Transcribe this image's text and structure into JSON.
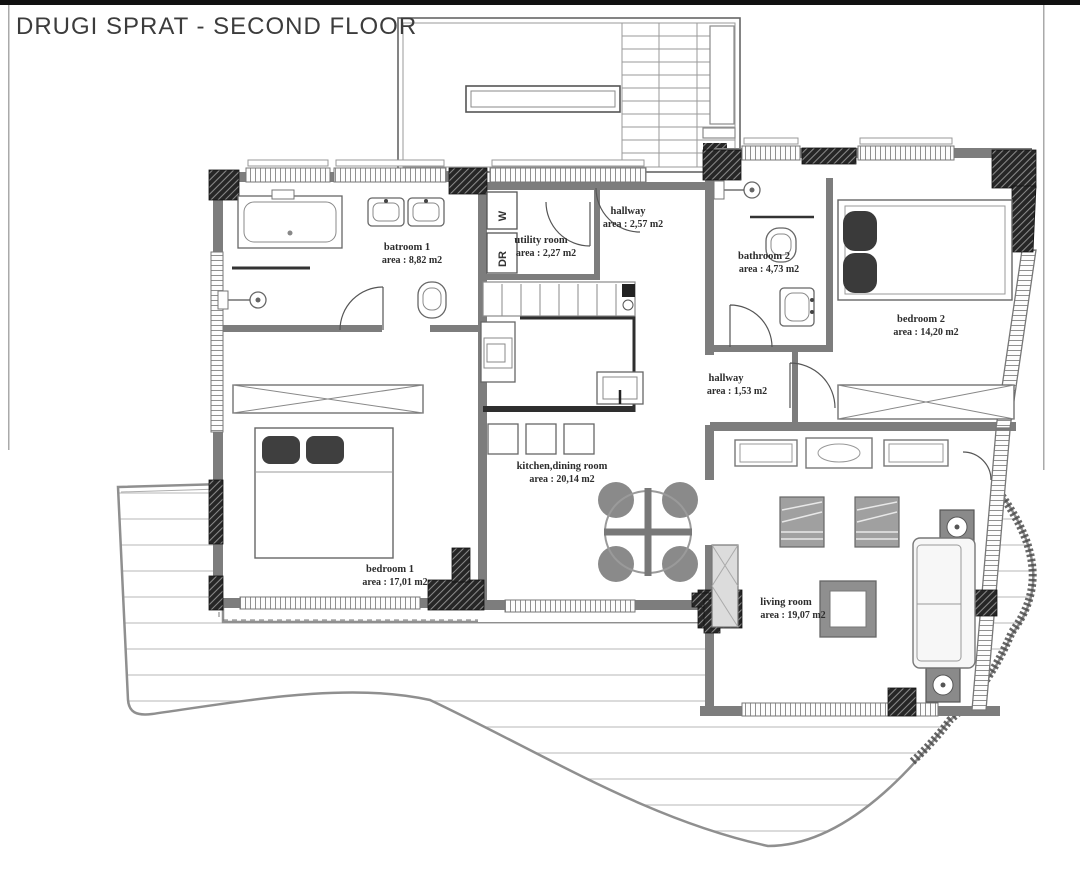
{
  "title": "DRUGI SPRAT - SECOND FLOOR",
  "rooms": [
    {
      "name": "batroom 1",
      "area": "area : 8,82 m2"
    },
    {
      "name": "utility room",
      "area": "area : 2,27 m2"
    },
    {
      "name": "hallway",
      "area": "area : 2,57 m2"
    },
    {
      "name": "bathroom 2",
      "area": "area : 4,73 m2"
    },
    {
      "name": "bedroom 2",
      "area": "area : 14,20 m2"
    },
    {
      "name": "hallway",
      "area": "area : 1,53 m2"
    },
    {
      "name": "kitchen,dining room",
      "area": "area : 20,14 m2"
    },
    {
      "name": "bedroom 1",
      "area": "area : 17,01 m2"
    },
    {
      "name": "living room",
      "area": "area : 19,07 m2"
    }
  ],
  "appliances": {
    "washer": "W",
    "dryer": "DR"
  },
  "colors": {
    "wall": "#7d7d7d",
    "hatch": "#262626",
    "deck_line": "#c6c6c6",
    "text": "#2d2d2d"
  }
}
